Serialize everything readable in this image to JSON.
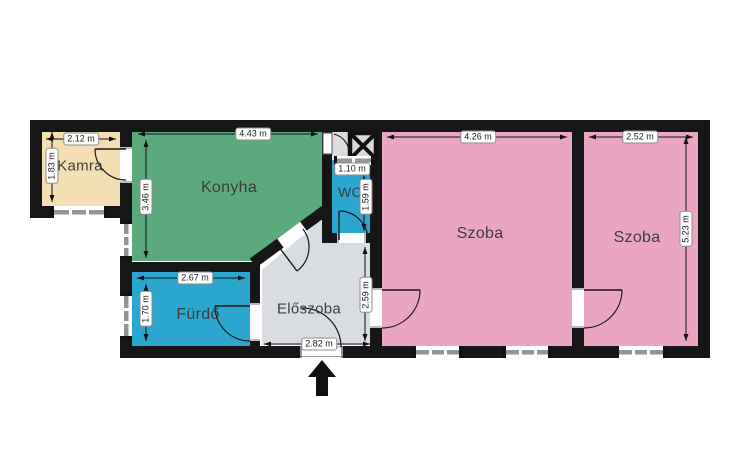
{
  "plan_type": "apartment-floor-plan",
  "rooms": {
    "kamra": {
      "label": "Kamra",
      "width": "2.12 m",
      "height": "1.83 m"
    },
    "konyha": {
      "label": "Konyha",
      "width": "4.43 m",
      "height": "3.46 m"
    },
    "wc": {
      "label": "WC",
      "width": "1.10 m",
      "height": "1.59 m"
    },
    "szoba1": {
      "label": "Szoba",
      "width": "4.26 m"
    },
    "szoba2": {
      "label": "Szoba",
      "width": "2.52 m",
      "height": "5.23 m"
    },
    "furdo": {
      "label": "Fürdő",
      "width": "2.67 m",
      "height": "1.70 m"
    },
    "eloszoba": {
      "label": "Előszoba",
      "height": "2.59 m",
      "entrance_width": "2.82 m"
    }
  },
  "colors": {
    "kamra": "#f3dfb3",
    "konyha": "#5ba97c",
    "wet": "#2ba6cf",
    "szoba": "#e9a5c1",
    "eloszoba": "#d9dce0",
    "cell": "#dcdcdc",
    "shaft": "#d9d9d9",
    "wall": "#161616",
    "window_bar": "#8f969b",
    "arrow": "#111111"
  },
  "symbols": {
    "entrance_arrow": "entrance-direction-arrow",
    "shaft_cross": "ventilation-shaft"
  }
}
